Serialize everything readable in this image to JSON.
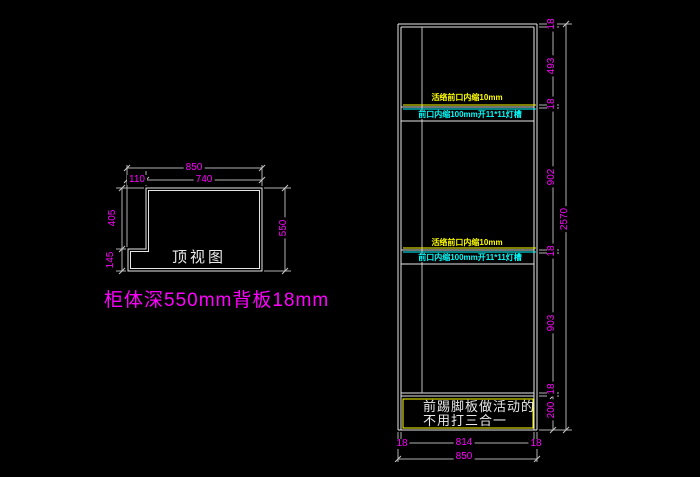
{
  "colors": {
    "background": "#000000",
    "outline": "#e8e8e8",
    "dimension_text": "#ff00ff",
    "annotation_yellow": "#ffff00",
    "annotation_cyan": "#00ffff"
  },
  "top_view": {
    "title": "顶视图",
    "dims": {
      "overall_width": "850",
      "notch_width": "110",
      "top_width": "740",
      "left_upper": "405",
      "left_lower": "145",
      "depth": "550"
    }
  },
  "caption": "柜体深550mm背板18mm",
  "elevation": {
    "notes": {
      "shelf1_yellow": "活络前口内缩10mm",
      "shelf1_cyan": "前口内缩100mm开11*11灯槽",
      "shelf2_yellow": "活络前口内缩10mm",
      "shelf2_cyan": "前口内缩100mm开11*11灯槽",
      "toe_kick_line1": "前踢脚板做活动的",
      "toe_kick_line2": "不用打三合一"
    },
    "height_dims": [
      "18",
      "493",
      "18",
      "902",
      "18",
      "903",
      "18",
      "200"
    ],
    "overall_height": "2570",
    "width_dims": [
      "18",
      "814",
      "18"
    ],
    "overall_width": "850"
  }
}
